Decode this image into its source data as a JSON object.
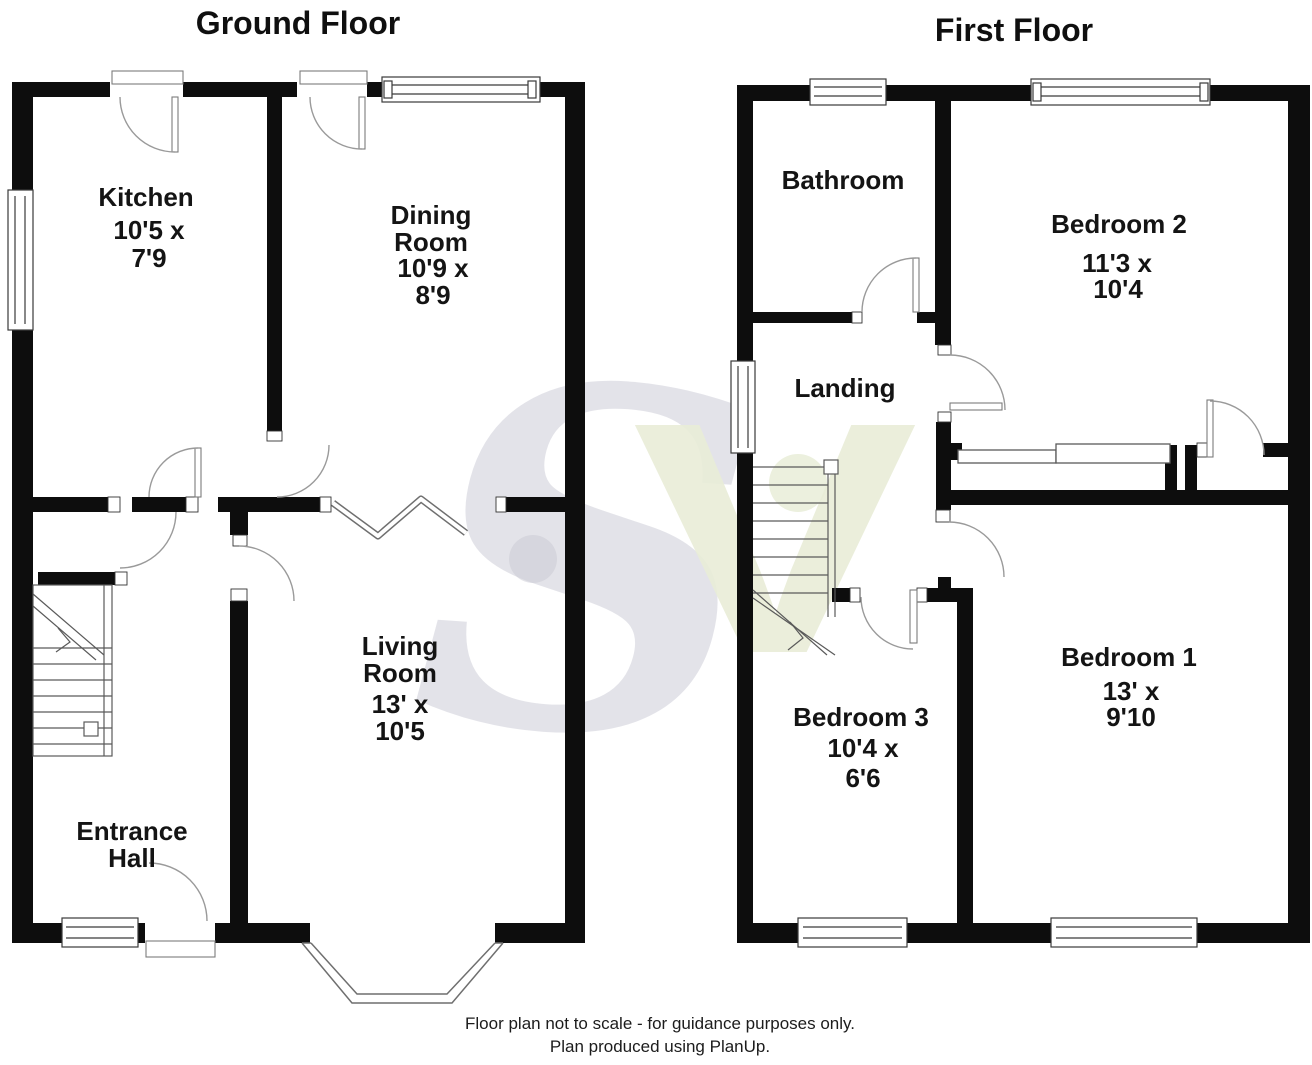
{
  "ground": {
    "title": "Ground Floor",
    "rooms": {
      "kitchen": {
        "name": "Kitchen",
        "dim1": "10'5 x",
        "dim2": "7'9"
      },
      "dining": {
        "name1": "Dining",
        "name2": "Room",
        "dim1": "10'9 x",
        "dim2": "8'9"
      },
      "living": {
        "name1": "Living",
        "name2": "Room",
        "dim1": "13' x",
        "dim2": "10'5"
      },
      "hall": {
        "name1": "Entrance",
        "name2": "Hall"
      }
    }
  },
  "first": {
    "title": "First Floor",
    "rooms": {
      "bathroom": {
        "name": "Bathroom"
      },
      "landing": {
        "name": "Landing"
      },
      "bedroom2": {
        "name": "Bedroom 2",
        "dim1": "11'3 x",
        "dim2": "10'4"
      },
      "bedroom3": {
        "name": "Bedroom 3",
        "dim1": "10'4 x",
        "dim2": "6'6"
      },
      "bedroom1": {
        "name": "Bedroom 1",
        "dim1": "13' x",
        "dim2": "9'10"
      }
    }
  },
  "footer": {
    "line1": "Floor plan not to scale - for guidance purposes only.",
    "line2": "Plan produced using PlanUp."
  },
  "watermark": {
    "letter1": "S",
    "letter2": "V"
  },
  "colors": {
    "wall": "#0d0d0d",
    "background": "#ffffff",
    "door_line": "#8f8f8f",
    "stair_line": "#5a5a5a",
    "watermark_gray": "#c9c9d4",
    "watermark_green": "#e9edd8"
  }
}
